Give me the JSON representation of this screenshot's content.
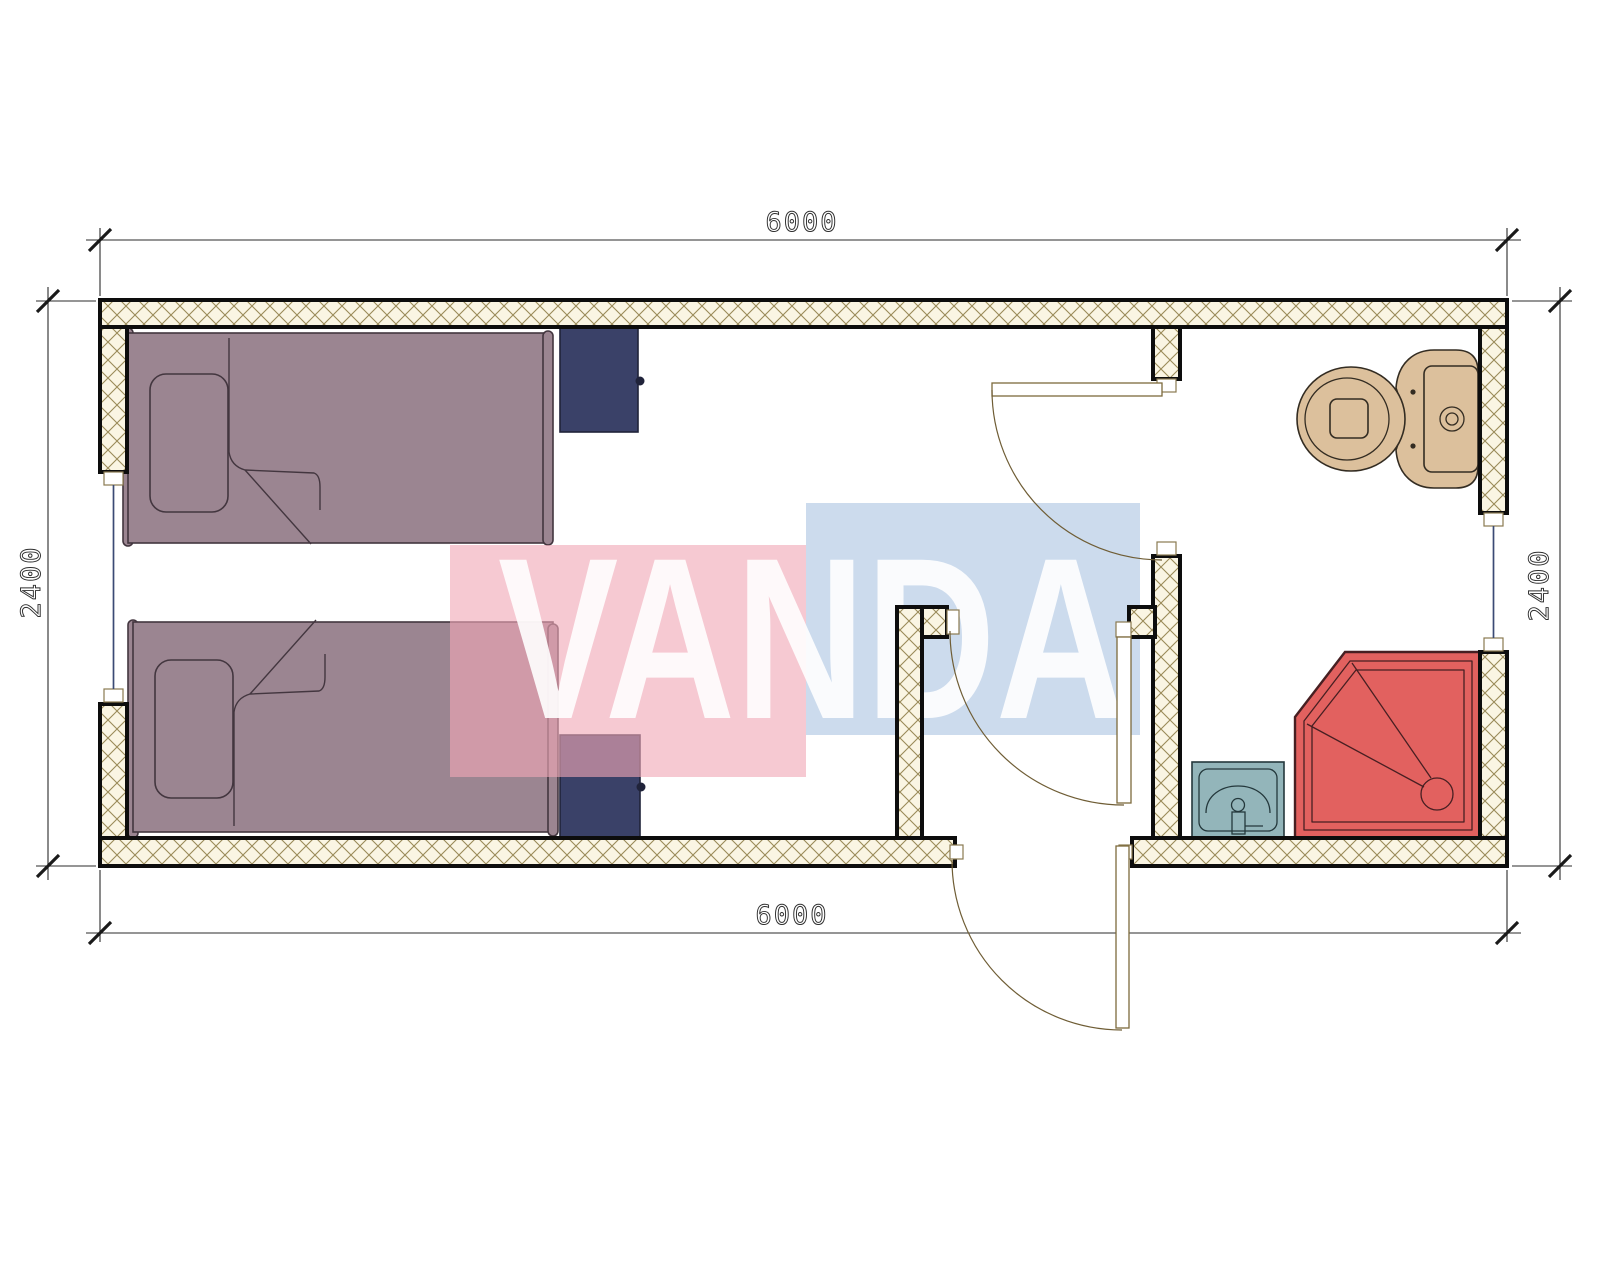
{
  "watermark": {
    "text": "VANDA",
    "red_color": "#f0a8b6",
    "blue_color": "#b9cde6",
    "text_color": "#ffffff"
  },
  "dimensions": {
    "top": "6000",
    "bottom": "6000",
    "left": "2400",
    "right": "2400"
  },
  "colors": {
    "bed": "#9b8591",
    "nightstand": "#3a4168",
    "toilet": "#dcc09c",
    "shower": "#e2615f",
    "sink": "#93b5ba",
    "wall_line": "#0d0d0d",
    "hatch_background": "#faf5e3",
    "hatch_line": "#9a8a58",
    "door_line": "#7d6a3c",
    "window_line": "#3b4a75"
  }
}
